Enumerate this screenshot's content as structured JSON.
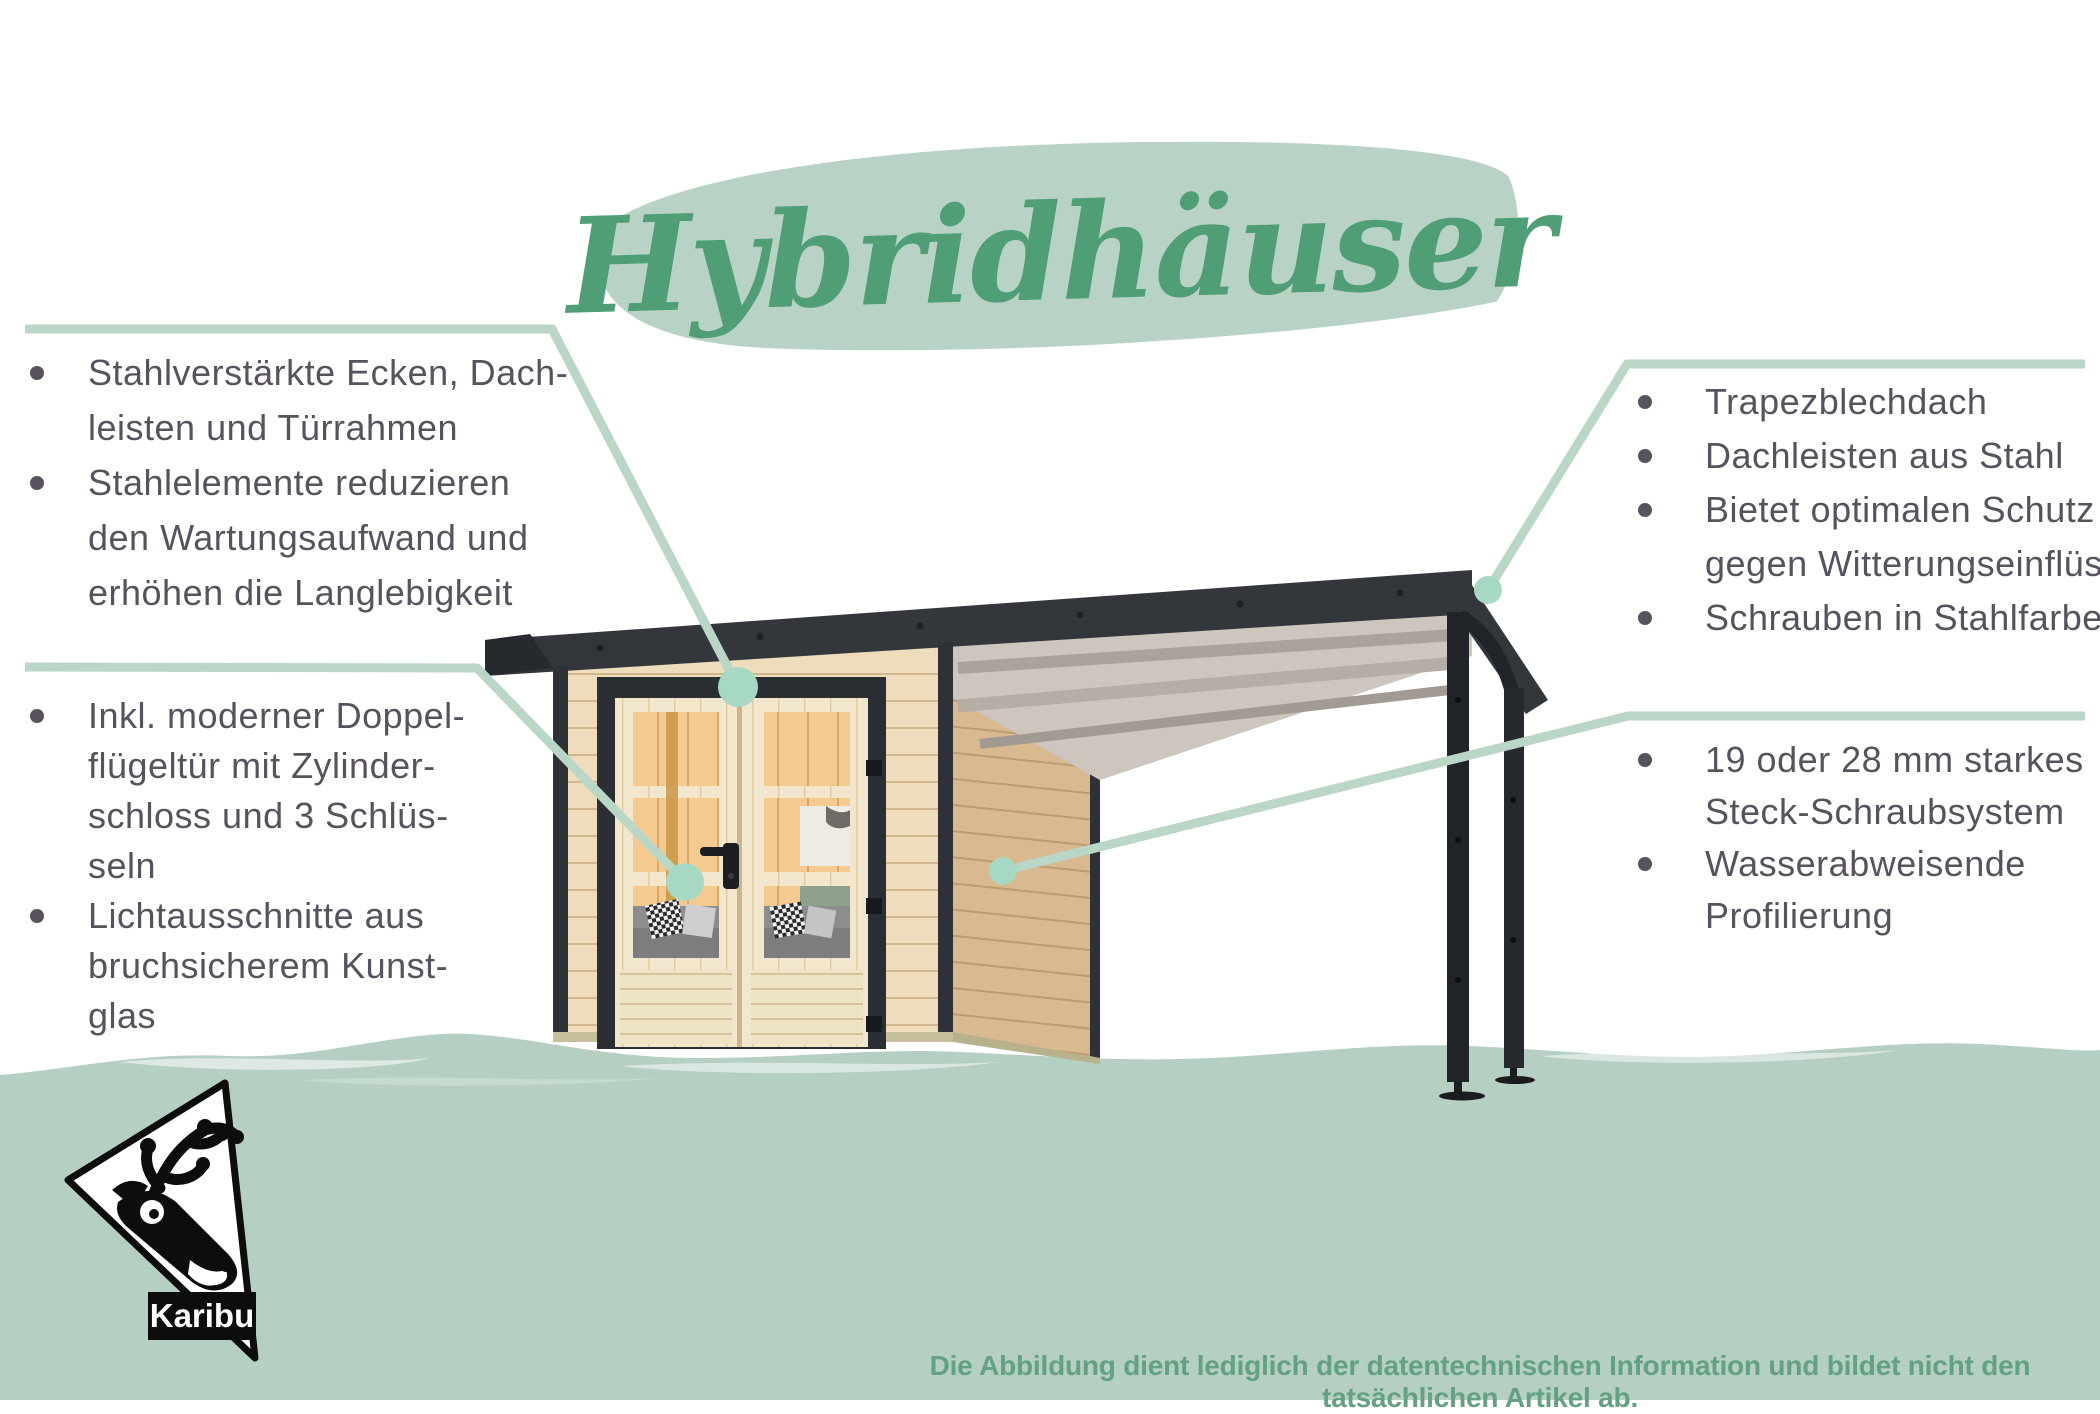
{
  "title": {
    "text": "Hybridhäuser"
  },
  "callouts": {
    "left_top": {
      "items": [
        {
          "bullet": true,
          "text": "Stahlverstärkte Ecken, Dach-"
        },
        {
          "bullet": false,
          "text": "leisten und Türrahmen"
        },
        {
          "bullet": true,
          "text": "Stahlelemente reduzieren"
        },
        {
          "bullet": false,
          "text": "den Wartungsaufwand und"
        },
        {
          "bullet": false,
          "text": "erhöhen die Langlebigkeit"
        }
      ]
    },
    "left_bottom": {
      "items": [
        {
          "bullet": true,
          "text": "Inkl. moderner Doppel-"
        },
        {
          "bullet": false,
          "text": "flügeltür mit Zylinder-"
        },
        {
          "bullet": false,
          "text": "schloss und 3 Schlüs-"
        },
        {
          "bullet": false,
          "text": "seln"
        },
        {
          "bullet": true,
          "text": "Lichtausschnitte aus"
        },
        {
          "bullet": false,
          "text": "bruchsicherem Kunst-"
        },
        {
          "bullet": false,
          "text": "glas"
        }
      ]
    },
    "right_top": {
      "items": [
        {
          "bullet": true,
          "text": "Trapezblechdach"
        },
        {
          "bullet": true,
          "text": "Dachleisten aus Stahl"
        },
        {
          "bullet": true,
          "text": "Bietet optimalen Schutz"
        },
        {
          "bullet": false,
          "text": "gegen Witterungseinflüsse"
        },
        {
          "bullet": true,
          "text": "Schrauben in Stahlfarbe"
        }
      ]
    },
    "right_bottom": {
      "items": [
        {
          "bullet": true,
          "text": "19 oder 28 mm starkes"
        },
        {
          "bullet": false,
          "text": "Steck-Schraubsystem"
        },
        {
          "bullet": true,
          "text": "Wasserabweisende"
        },
        {
          "bullet": false,
          "text": "Profilierung"
        }
      ]
    }
  },
  "footer": {
    "disclaimer": "Die Abbildung dient lediglich der datentechnischen Information und bildet nicht den tatsächlichen Artikel ab."
  },
  "logo": {
    "brand": "Karibu"
  },
  "colors": {
    "accent_green": "#4f9e75",
    "brush_green": "#b8d3c5",
    "line_green": "#b9d6c6",
    "dot_green": "#a7d8c3",
    "ground_green": "#b5cfc2",
    "text_dark": "#57525e",
    "disclaimer_green": "#63a182",
    "roof_dark": "#33373c",
    "wood_light": "#eedcbd",
    "wood_side": "#d9b98f",
    "wood_door": "#f2e7cd",
    "interior_wood": "#f4ca90"
  }
}
